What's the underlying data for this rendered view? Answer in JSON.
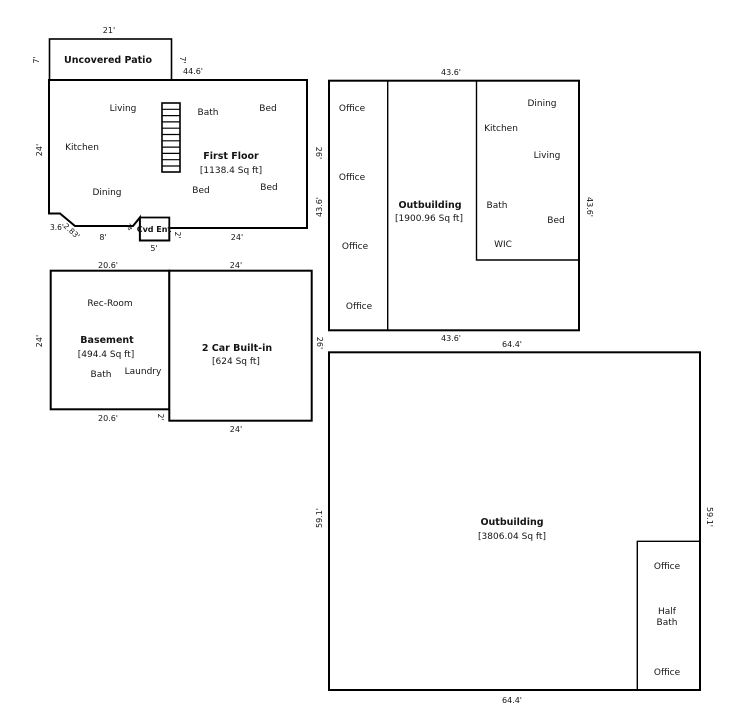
{
  "plan": {
    "background_color": "#ffffff",
    "line_color": "#000000",
    "patio": {
      "name": "Uncovered Patio",
      "dims": {
        "top": "21'",
        "left": "7'",
        "right": "7'"
      }
    },
    "first_floor": {
      "name": "First Floor",
      "area": "[1138.4 Sq ft]",
      "entry_label": "Cvd Ent",
      "rooms": {
        "living": "Living",
        "bath": "Bath",
        "bed_top": "Bed",
        "kitchen": "Kitchen",
        "dining": "Dining",
        "bed_bottom_mid": "Bed",
        "bed_bottom_right": "Bed"
      },
      "dims": {
        "top": "44.6'",
        "left": "24'",
        "right": "26'",
        "notch_side": "3.6'",
        "notch_diag": "2.83'",
        "porch": "8'",
        "entry_diag": "4'",
        "entry_width": "5'",
        "entry_side": "2'",
        "bottom": "24'"
      }
    },
    "basement": {
      "name": "Basement",
      "area": "[494.4 Sq ft]",
      "rooms": {
        "rec_room": "Rec-Room",
        "bath": "Bath",
        "laundry": "Laundry"
      },
      "dims": {
        "top": "20.6'",
        "left": "24'",
        "bottom": "20.6'",
        "offset": "2'"
      }
    },
    "garage": {
      "name": "2 Car Built-in",
      "area": "[624 Sq ft]",
      "dims": {
        "top": "24'",
        "right": "26'",
        "bottom": "24'"
      }
    },
    "outbuilding1": {
      "name": "Outbuilding",
      "area": "[1900.96 Sq ft]",
      "offices": [
        "Office",
        "Office",
        "Office",
        "Office"
      ],
      "rooms": {
        "dining": "Dining",
        "kitchen": "Kitchen",
        "living": "Living",
        "bath": "Bath",
        "bed": "Bed",
        "wic": "WIC"
      },
      "dims": {
        "top": "43.6'",
        "left": "43.6'",
        "right": "43.6'",
        "bottom": "43.6'"
      }
    },
    "outbuilding2": {
      "name": "Outbuilding",
      "area": "[3806.04 Sq ft]",
      "rooms": {
        "office_top": "Office",
        "half_bath_line1": "Half",
        "half_bath_line2": "Bath",
        "office_bottom": "Office"
      },
      "dims": {
        "top": "64.4'",
        "left": "59.1'",
        "right": "59.1'",
        "bottom": "64.4'"
      }
    }
  }
}
